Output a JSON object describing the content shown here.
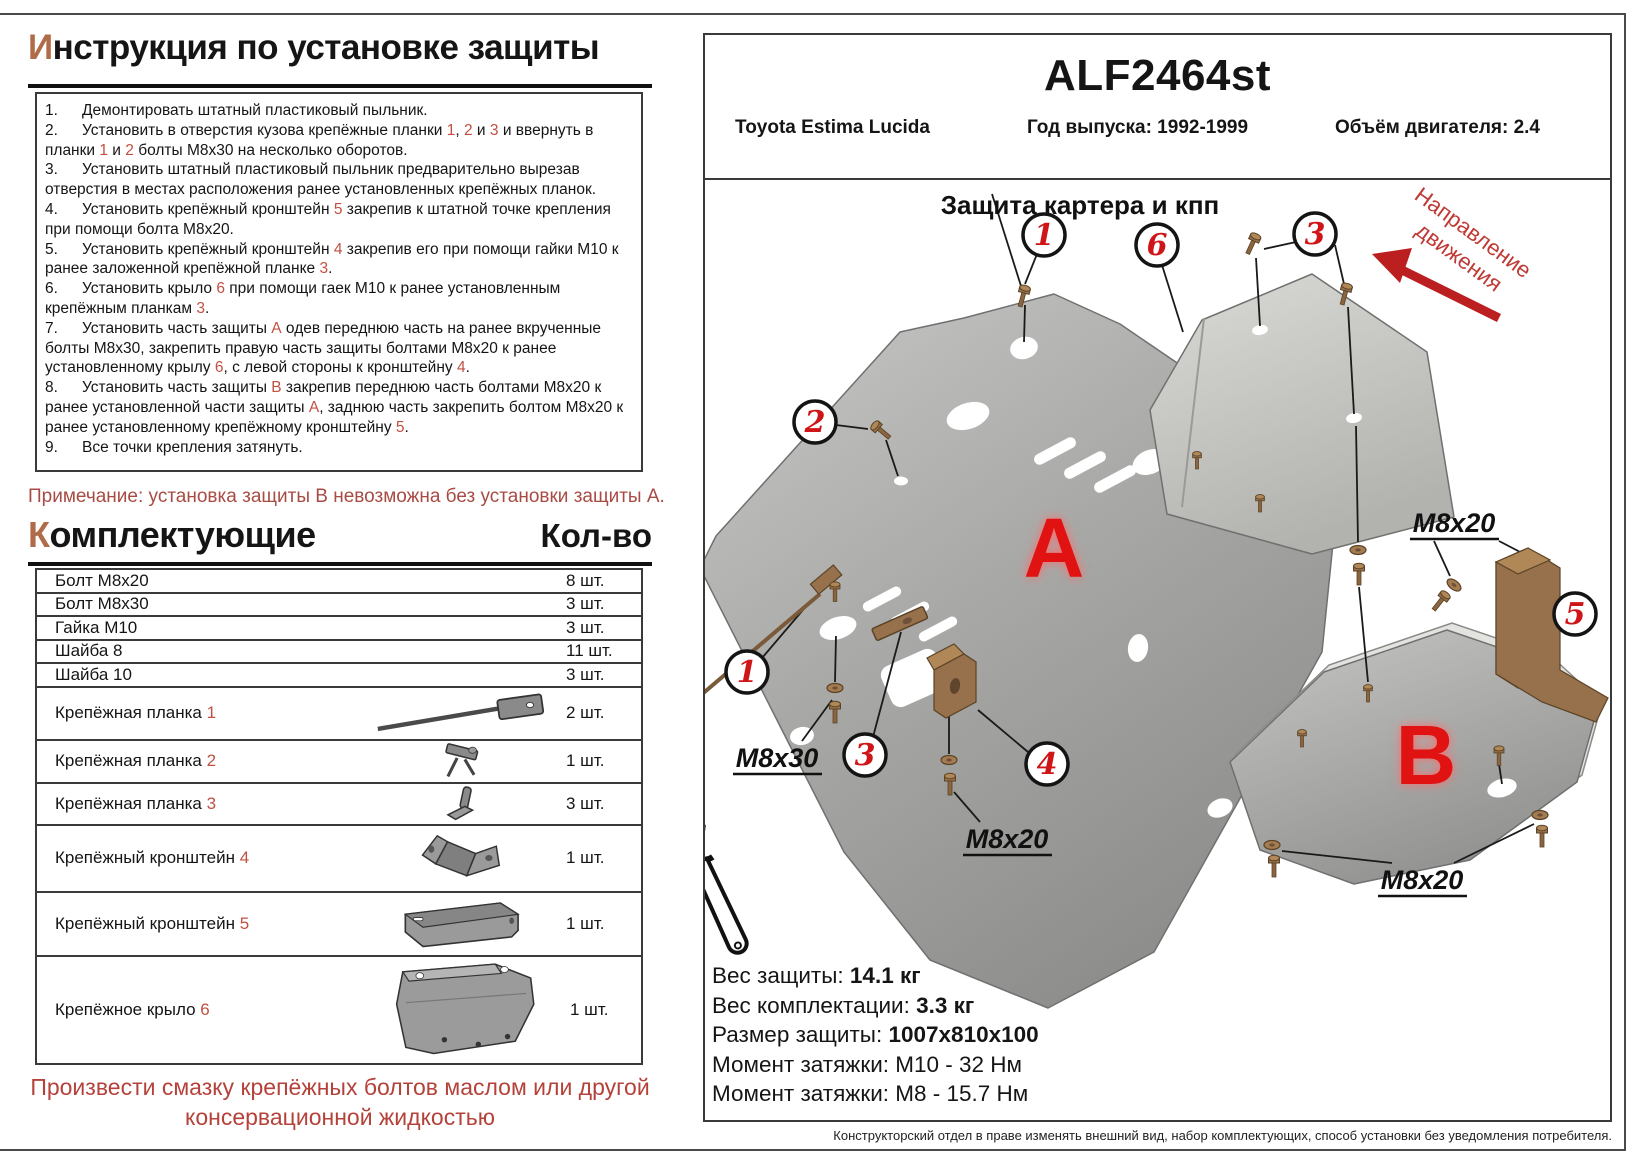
{
  "left": {
    "title": {
      "first": "И",
      "rest": "нструкция по установке защиты"
    },
    "instructions": [
      {
        "num": "1.",
        "segments": [
          {
            "t": "Демонтировать штатный пластиковый пыльник."
          }
        ]
      },
      {
        "num": "2.",
        "segments": [
          {
            "t": "Установить в отверстия кузова крепёжные планки "
          },
          {
            "t": "1",
            "red": true
          },
          {
            "t": ", "
          },
          {
            "t": "2",
            "red": true
          },
          {
            "t": " и "
          },
          {
            "t": "3",
            "red": true
          },
          {
            "t": " и ввернуть в планки "
          },
          {
            "t": "1",
            "red": true
          },
          {
            "t": " и "
          },
          {
            "t": "2",
            "red": true
          },
          {
            "t": " болты М8х30 на несколько оборотов."
          }
        ]
      },
      {
        "num": "3.",
        "segments": [
          {
            "t": "Установить штатный пластиковый пыльник предварительно вырезав отверстия в местах расположения ранее установленных крепёжных планок."
          }
        ]
      },
      {
        "num": "4.",
        "segments": [
          {
            "t": "Установить крепёжный кронштейн "
          },
          {
            "t": "5",
            "red": true
          },
          {
            "t": " закрепив к штатной точке крепления при помощи болта М8х20."
          }
        ]
      },
      {
        "num": "5.",
        "segments": [
          {
            "t": "Установить крепёжный кронштейн "
          },
          {
            "t": "4",
            "red": true
          },
          {
            "t": " закрепив его при помощи гайки М10 к ранее заложенной крепёжной планке "
          },
          {
            "t": "3",
            "red": true
          },
          {
            "t": "."
          }
        ]
      },
      {
        "num": "6.",
        "segments": [
          {
            "t": "Установить крыло "
          },
          {
            "t": "6",
            "red": true
          },
          {
            "t": " при помощи гаек М10 к ранее установленным крепёжным планкам "
          },
          {
            "t": "3",
            "red": true
          },
          {
            "t": "."
          }
        ]
      },
      {
        "num": "7.",
        "segments": [
          {
            "t": "Установить часть защиты "
          },
          {
            "t": "А",
            "red": true
          },
          {
            "t": " одев переднюю часть на ранее вкрученные болты М8х30, закрепить правую часть защиты болтами М8х20 к ранее установленному крылу "
          },
          {
            "t": "6",
            "red": true
          },
          {
            "t": ", с левой стороны к кронштейну "
          },
          {
            "t": "4",
            "red": true
          },
          {
            "t": "."
          }
        ]
      },
      {
        "num": "8.",
        "segments": [
          {
            "t": "Установить часть защиты "
          },
          {
            "t": "В",
            "red": true
          },
          {
            "t": " закрепив переднюю часть болтами М8х20 к ранее установленной части защиты "
          },
          {
            "t": "А",
            "red": true
          },
          {
            "t": ", заднюю часть закрепить болтом М8х20 к ранее установленному крепёжному кронштейну "
          },
          {
            "t": "5",
            "red": true
          },
          {
            "t": "."
          }
        ]
      },
      {
        "num": "9.",
        "segments": [
          {
            "t": "Все точки крепления затянуть."
          }
        ]
      }
    ],
    "note": "Примечание: установка защиты В невозможна без установки защиты А.",
    "components_title": {
      "first": "К",
      "rest": "омплектующие"
    },
    "qty_header": "Кол-во",
    "parts": [
      {
        "name": [
          {
            "t": "Болт М8х20"
          }
        ],
        "qty": "8 шт.",
        "icon": "none"
      },
      {
        "name": [
          {
            "t": "Болт М8х30"
          }
        ],
        "qty": "3 шт.",
        "icon": "none"
      },
      {
        "name": [
          {
            "t": "Гайка М10"
          }
        ],
        "qty": "3 шт.",
        "icon": "none"
      },
      {
        "name": [
          {
            "t": "Шайба 8"
          }
        ],
        "qty": "11 шт.",
        "icon": "none"
      },
      {
        "name": [
          {
            "t": "Шайба 10"
          }
        ],
        "qty": "3 шт.",
        "icon": "none"
      },
      {
        "name": [
          {
            "t": "Крепёжная планка "
          },
          {
            "t": "1",
            "red": true
          }
        ],
        "qty": "2 шт.",
        "icon": "rod"
      },
      {
        "name": [
          {
            "t": "Крепёжная планка "
          },
          {
            "t": "2",
            "red": true
          }
        ],
        "qty": "1 шт.",
        "icon": "plank2"
      },
      {
        "name": [
          {
            "t": "Крепёжная планка "
          },
          {
            "t": "3",
            "red": true
          }
        ],
        "qty": "3 шт.",
        "icon": "plank3"
      },
      {
        "name": [
          {
            "t": "Крепёжный кронштейн "
          },
          {
            "t": "4",
            "red": true
          }
        ],
        "qty": "1 шт.",
        "icon": "bracketZ"
      },
      {
        "name": [
          {
            "t": "Крепёжный кронштейн "
          },
          {
            "t": "5",
            "red": true
          }
        ],
        "qty": "1 шт.",
        "icon": "bracketU"
      },
      {
        "name": [
          {
            "t": "Крепёжное крыло "
          },
          {
            "t": "6",
            "red": true
          }
        ],
        "qty": "1 шт.",
        "icon": "fender"
      }
    ],
    "bottom_note_lines": [
      "Произвести смазку крепёжных болтов маслом или другой",
      "консервационной жидкостью"
    ]
  },
  "header": {
    "code": "ALF2464st",
    "model": "Toyota Estima Lucida",
    "year": "Год выпуска: 1992-1999",
    "engine": "Объём двигателя: 2.4"
  },
  "diagram": {
    "title": "Защита картера и кпп",
    "direction_line1": "Направление",
    "direction_line2": "движения",
    "part_a": "A",
    "part_b": "B",
    "callouts": {
      "c1t": "1",
      "c6": "6",
      "c3t": "3",
      "c2": "2",
      "c1l": "1",
      "c3b": "3",
      "c4": "4",
      "c5": "5"
    },
    "labels": {
      "m8x20_tr": "М8х20",
      "m8x30": "М8х30",
      "m8x20_bm": "М8х20",
      "m8x20_br": "М8х20"
    }
  },
  "specs": {
    "rows": [
      {
        "label": "Вес защиты: ",
        "value": "14.1 кг",
        "bold": true
      },
      {
        "label": "Вес комплектации: ",
        "value": "3.3 кг",
        "bold": true
      },
      {
        "label": "Размер защиты: ",
        "value": "1007x810x100",
        "bold": true
      },
      {
        "label": "Момент затяжки:  ",
        "value": "М10 - 32 Нм",
        "bold": false
      },
      {
        "label": "Момент затяжки:  ",
        "value": "М8 - 15.7 Нм",
        "bold": false
      }
    ]
  },
  "footer": "Конструкторский отдел в праве изменять внешний вид, набор комплектующих, способ установки без уведомления потребителя.",
  "colors": {
    "accent_red": "#d31510",
    "soft_red": "#c25042",
    "title_letter": "#b06b49",
    "note_red": "#a84b44",
    "bottom_red": "#b5423a",
    "bronze": "#96714b",
    "plate_gray": "#a8a8a6"
  }
}
